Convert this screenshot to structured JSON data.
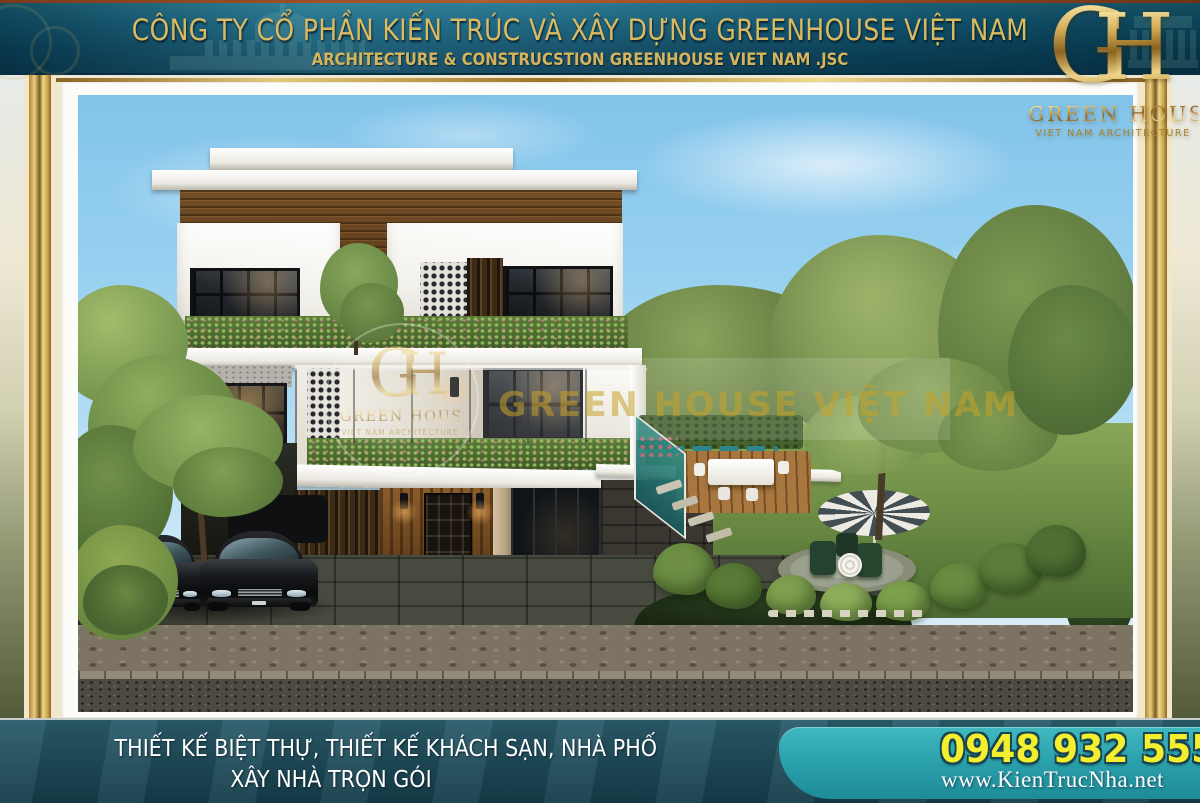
{
  "banner": {
    "title": "CÔNG TY CỔ PHẦN KIẾN TRÚC VÀ XÂY DỰNG GREENHOUSE VIỆT NAM",
    "subtitle": "ARCHITECTURE & CONSTRUCSTION GREENHOUSE VIET NAM .JSC"
  },
  "logo": {
    "monogram_g": "G",
    "monogram_h": "H",
    "name": "GREEN HOUSE",
    "tagline": "VIET NAM ARCHITECTURE"
  },
  "watermark": {
    "monogram_g": "G",
    "monogram_h": "H",
    "name": "GREEN HOUSE",
    "tagline": "VIET NAM ARCHITECTURE",
    "overlay_text": "GREEN HOUSE VIỆT NAM"
  },
  "footer": {
    "services_line1": "THIẾT KẾ BIỆT THỰ, THIẾT KẾ KHÁCH SẠN, NHÀ PHỐ",
    "services_line2": "XÂY NHÀ TRỌN GÓI",
    "phone": "0948 932 555",
    "website": "www.KienTrucNha.net"
  },
  "colors": {
    "banner_teal": "#0d4a64",
    "gold": "#d8b660",
    "frame_gold": "#c9a24b",
    "footer_dark_teal": "#1e4a58",
    "footer_bright_teal": "#2ba2ad",
    "phone_yellow": "#f3ef2e",
    "mat_white": "#fcfcf9"
  }
}
